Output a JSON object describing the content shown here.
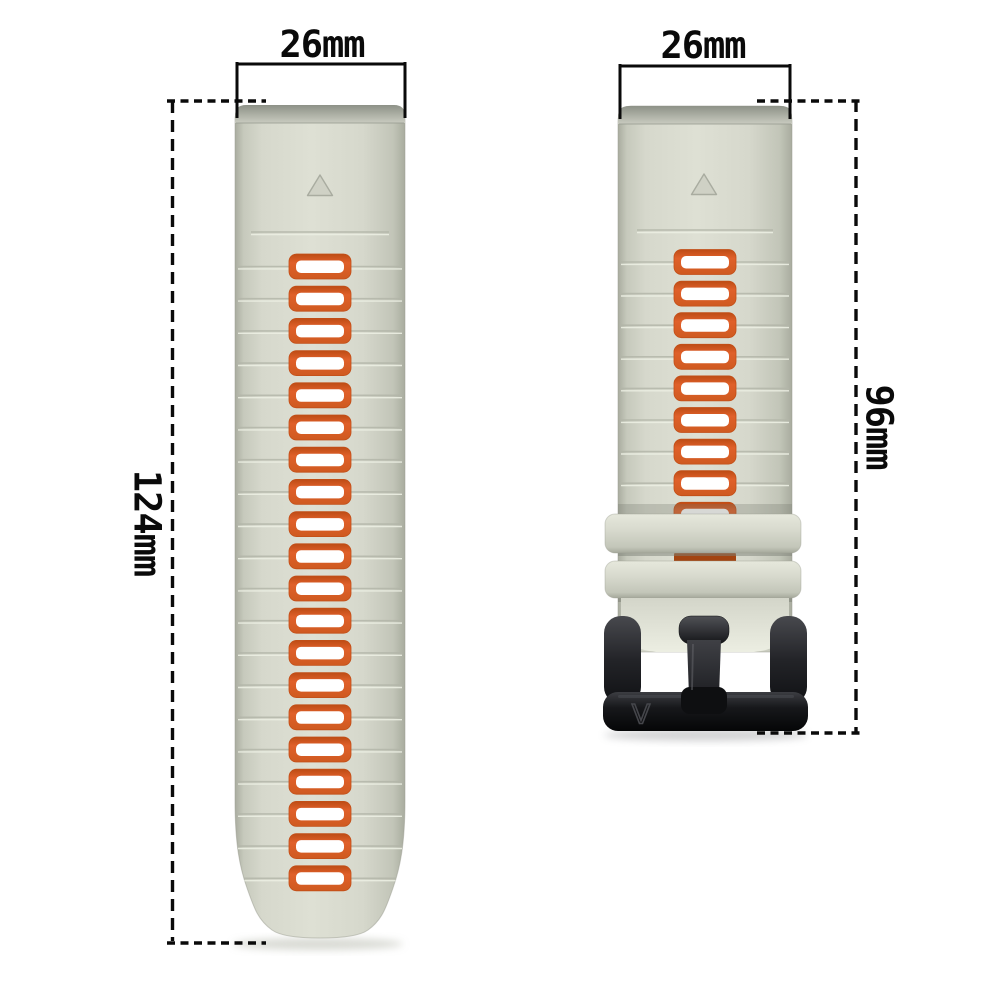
{
  "product": {
    "type": "two-piece watch strap with buckle",
    "strap_color_name": "starlight gray",
    "accent_color_name": "orange"
  },
  "annotations": {
    "left_strap_width": "26mm",
    "right_strap_width": "26mm",
    "left_strap_length": "124mm",
    "right_strap_length": "96mm"
  },
  "buckle": {
    "logo": "V"
  },
  "straps": {
    "left": {
      "slot_count": 20
    },
    "right": {
      "slot_count": 9
    }
  },
  "colors": {
    "background": "#ffffff",
    "annotation_ink": "#0a0a0a",
    "strap_body": "#dcded2",
    "strap_edge": "#a9ac9f",
    "strap_cap": "#8d9187",
    "keeper": "#d8dace",
    "slot_orange": "#e0602a",
    "slot_border_dark": "#c24e17",
    "slot_inner": "#ffffff",
    "gap_slot_shaded": "#a34410",
    "groove_dark": "#b2b5a8",
    "groove_light": "#ecefe3",
    "buckle_black": "#17181b",
    "triangle_marker": "#cfd1c5"
  }
}
